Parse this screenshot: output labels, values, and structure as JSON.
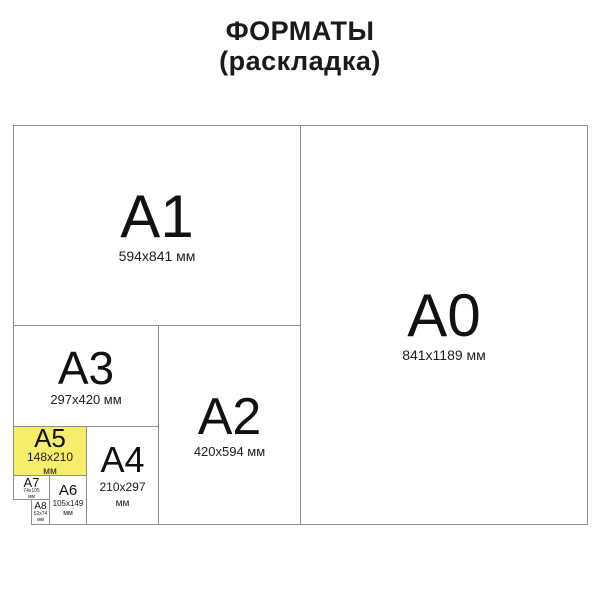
{
  "title": {
    "line1": "ФОРМАТЫ",
    "line2": "(раскладка)"
  },
  "colors": {
    "highlight_fill": "#f6ee6a",
    "border": "#8f8f8f",
    "text": "#111111"
  },
  "formats": {
    "a0": {
      "label": "A0",
      "size": "841x1189 мм"
    },
    "a1": {
      "label": "A1",
      "size": "594x841 мм"
    },
    "a2": {
      "label": "A2",
      "size": "420x594 мм"
    },
    "a3": {
      "label": "A3",
      "size": "297x420 мм"
    },
    "a4": {
      "label": "A4",
      "size": "210x297",
      "unit": "мм"
    },
    "a5": {
      "label": "A5",
      "size": "148x210",
      "unit": "мм",
      "highlighted": true
    },
    "a6": {
      "label": "A6",
      "size": "105x149",
      "unit": "мм"
    },
    "a7": {
      "label": "A7",
      "size": "74x105",
      "unit": "мм"
    },
    "a8": {
      "label": "A8",
      "size": "52x74",
      "unit": "мм"
    }
  }
}
